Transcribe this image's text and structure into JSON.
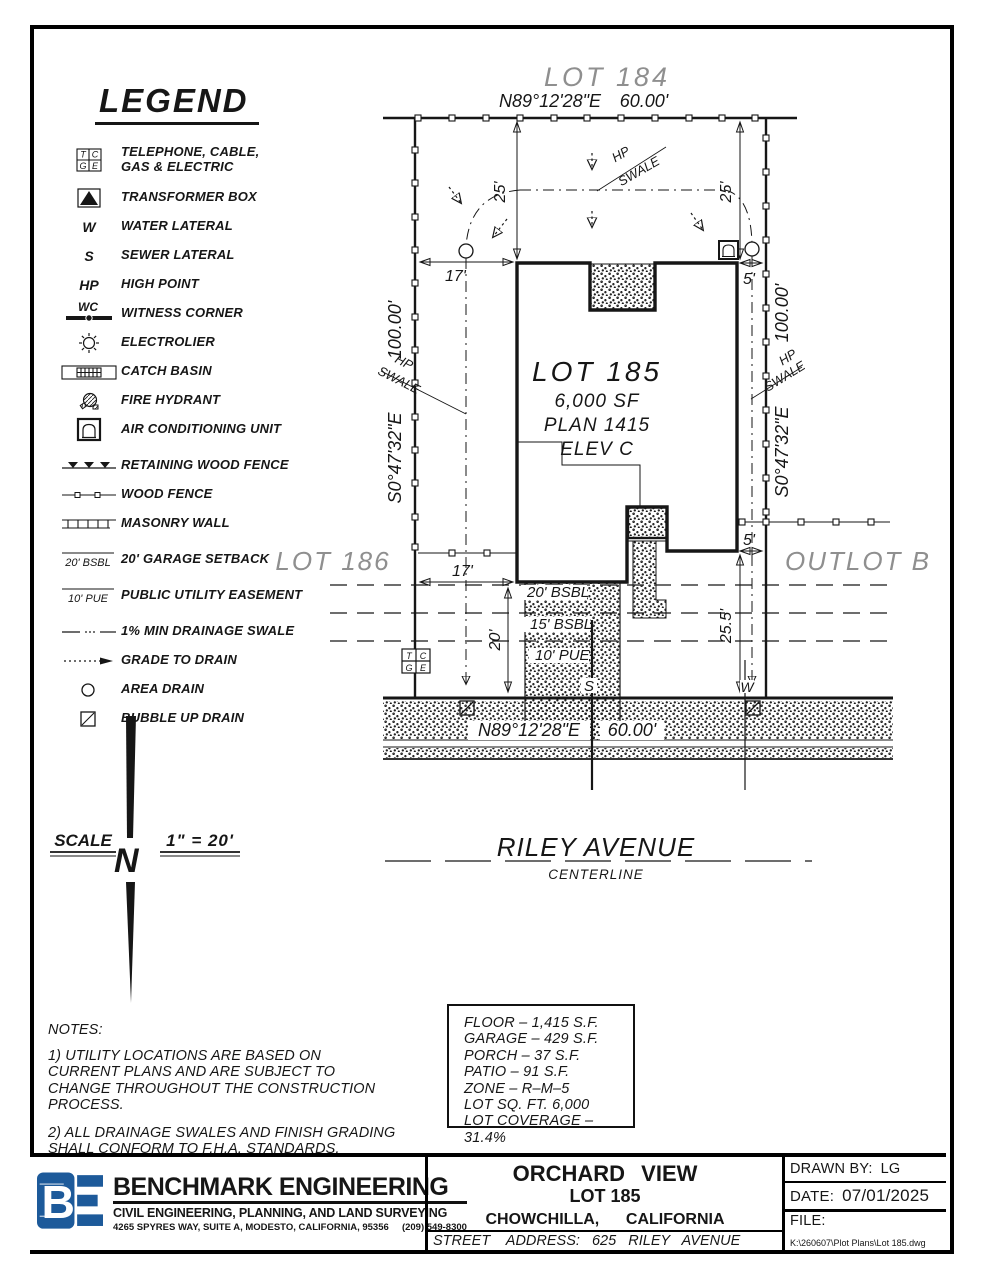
{
  "legend": {
    "title": "LEGEND",
    "sym": {
      "tcge_t": "T",
      "tcge_c": "C",
      "tcge_g": "G",
      "tcge_e": "E",
      "w": "W",
      "s": "S",
      "hp": "HP",
      "wc": "WC",
      "bsbl": "20' BSBL",
      "pue": "10' PUE"
    },
    "items": [
      {
        "label": "TELEPHONE, CABLE, GAS & ELECTRIC"
      },
      {
        "label": "TRANSFORMER BOX"
      },
      {
        "label": "WATER LATERAL"
      },
      {
        "label": "SEWER LATERAL"
      },
      {
        "label": "HIGH POINT"
      },
      {
        "label": "WITNESS CORNER"
      },
      {
        "label": "ELECTROLIER"
      },
      {
        "label": "CATCH BASIN"
      },
      {
        "label": "FIRE HYDRANT"
      },
      {
        "label": "AIR CONDITIONING UNIT"
      },
      {
        "label": "RETAINING WOOD FENCE"
      },
      {
        "label": "WOOD FENCE"
      },
      {
        "label": "MASONRY WALL"
      },
      {
        "label": "20' GARAGE SETBACK"
      },
      {
        "label": "PUBLIC UTILITY EASEMENT"
      },
      {
        "label": "1% MIN DRAINAGE SWALE"
      },
      {
        "label": "GRADE TO DRAIN"
      },
      {
        "label": "AREA DRAIN"
      },
      {
        "label": "BUBBLE UP DRAIN"
      }
    ]
  },
  "plan": {
    "lot_north": "LOT 184",
    "lot_west": "LOT 186",
    "outlot": "OUTLOT B",
    "lot_label": "LOT 185",
    "lot_area": "6,000 SF",
    "plan_num": "PLAN 1415",
    "elev": "ELEV C",
    "bearing_ew": "N89°12'28\"E",
    "frontage": "60.00'",
    "bearing_ns": "S0°47'32\"E",
    "side": "100.00'",
    "hp": "HP",
    "swale": "SWALE",
    "bsbl20": "20' BSBL",
    "bsbl15": "15' BSBL",
    "pue10": "10' PUE",
    "sewer": "S",
    "water": "W",
    "street": "RILEY AVENUE",
    "centerline": "CENTERLINE",
    "dims": {
      "d17_top": "17'",
      "d5_top": "5'",
      "d25_left": "25'",
      "d25_right": "25'",
      "d17_bot": "17'",
      "d20": "20'",
      "d25_5": "25.5'",
      "d5_bot": "5'"
    }
  },
  "scale": {
    "label": "SCALE",
    "value": "1\" = 20'",
    "north": "N"
  },
  "notes": {
    "title": "NOTES:",
    "n1": "1) UTILITY LOCATIONS ARE BASED ON CURRENT PLANS AND ARE SUBJECT TO CHANGE THROUGHOUT THE CONSTRUCTION PROCESS.",
    "n2": "2) ALL DRAINAGE SWALES AND FINISH GRADING SHALL CONFORM TO F.H.A. STANDARDS."
  },
  "stats": {
    "lines": [
      "FLOOR – 1,415 S.F.",
      "GARAGE – 429 S.F.",
      "PORCH – 37 S.F.",
      "PATIO – 91 S.F.",
      "ZONE – R–M–5",
      "LOT SQ. FT. 6,000",
      "LOT COVERAGE – 31.4%"
    ]
  },
  "titleblock": {
    "firm": {
      "logo_text": "BE",
      "logo_color": "#1d5a9a",
      "name": "BENCHMARK ENGINEERING",
      "tagline": "CIVIL ENGINEERING, PLANNING, AND LAND SURVEYING",
      "address": "4265 SPYRES WAY, SUITE A, MODESTO, CALIFORNIA, 95356     (209) 549-8300"
    },
    "project": {
      "name": "ORCHARD VIEW",
      "lot": "LOT 185",
      "city": "CHOWCHILLA,      CALIFORNIA",
      "street": "STREET    ADDRESS:   625   RILEY   AVENUE"
    },
    "meta": {
      "drawn_by_label": "DRAWN  BY:",
      "drawn_by": "LG",
      "date_label": "DATE:",
      "date": "07/01/2025",
      "file_label": "FILE:",
      "file_path": "K:\\260607\\Plot Plans\\Lot 185.dwg"
    }
  }
}
